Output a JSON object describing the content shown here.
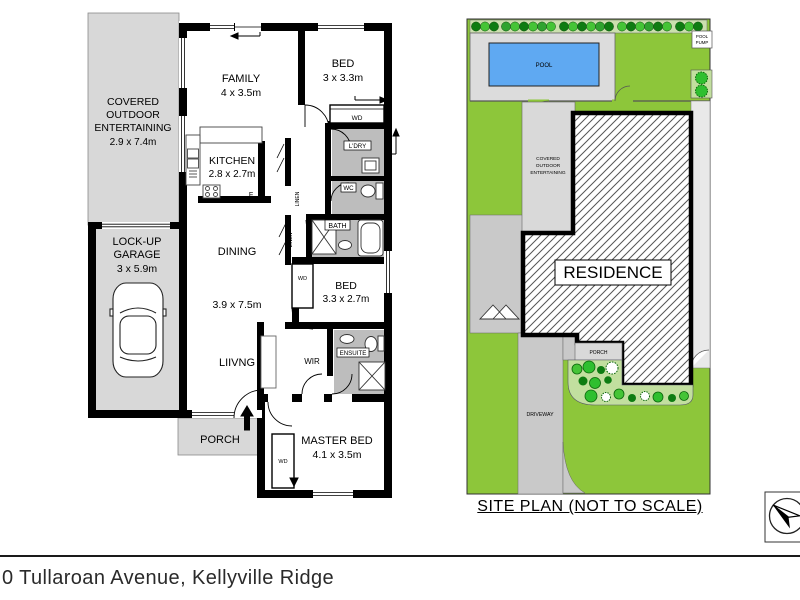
{
  "page": {
    "address": "0 Tullaroan Avenue, Kellyville Ridge"
  },
  "floorplan": {
    "covered": {
      "l1": "COVERED",
      "l2": "OUTDOOR",
      "l3": "ENTERTAINING",
      "dim": "2.9 x 7.4m"
    },
    "family": {
      "name": "FAMILY",
      "dim": "4 x 3.5m"
    },
    "bed1": {
      "name": "BED",
      "dim": "3 x 3.3m"
    },
    "kitchen": {
      "name": "KITCHEN",
      "dim": "2.8 x 2.7m"
    },
    "fridge": "F",
    "laundry": "L'DRY",
    "wc": "WC",
    "bath": "BATH",
    "pantry": "PTRY",
    "linen_top": "LINEN",
    "linen_mid": "LINEN",
    "dining": "DINING",
    "open_dim": "3.9 x 7.5m",
    "living": "LIIVNG",
    "bed2": {
      "name": "BED",
      "dim": "3.3 x 2.7m"
    },
    "garage": {
      "l1": "LOCK-UP",
      "l2": "GARAGE",
      "dim": "3 x 5.9m"
    },
    "porch": "PORCH",
    "wir": "WIR",
    "ensuite": "ENSUITE",
    "master": {
      "name": "MASTER BED",
      "dim": "4.1 x 3.5m"
    },
    "wd_bed1": "WD",
    "wd_bed2": "WD",
    "wd_master": "WD"
  },
  "siteplan": {
    "pool": "POOL",
    "pump": {
      "l1": "POOL",
      "l2": "PUMP"
    },
    "covered": {
      "l1": "COVERED",
      "l2": "OUTDOOR",
      "l3": "ENTERTAINING"
    },
    "residence": "RESIDENCE",
    "porch": "PORCH",
    "driveway": "DRIVEWAY",
    "caption": "SITE PLAN (NOT TO SCALE)"
  },
  "colors": {
    "walls": "#000000",
    "outdoor_grey": "#d8d8d8",
    "wet_grey": "#bdbdbd",
    "lawn_green": "#8dc63a",
    "hedge_strip": "#cbe0ae",
    "garden_bed": "#c2df9f",
    "pool_blue": "#5fa9f2"
  }
}
